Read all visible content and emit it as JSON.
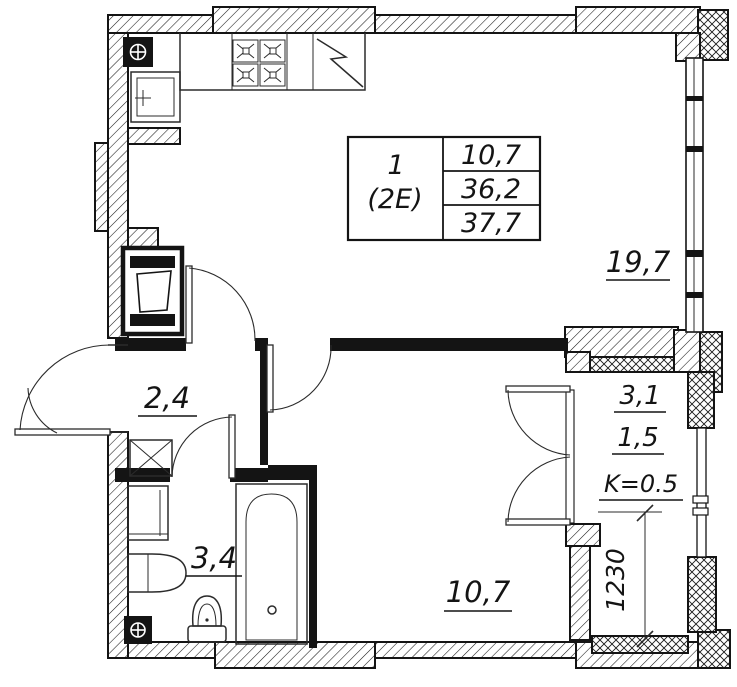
{
  "title": "Apartment floor plan",
  "info_table": {
    "apartment_number": "1",
    "apartment_type": "(2E)",
    "areas": [
      "10,7",
      "36,2",
      "37,7"
    ]
  },
  "rooms": {
    "living": {
      "area": "19,7"
    },
    "hall": {
      "area": "2,4"
    },
    "bathroom": {
      "area": "3,4"
    },
    "bedroom": {
      "area": "10,7"
    },
    "loggia": {
      "area_full": "3,1",
      "area_counted": "1,5",
      "coefficient": "K=0.5"
    }
  },
  "dimensions": {
    "loggia_depth": "1230"
  },
  "fixtures": [
    "gas-stove",
    "refrigerator",
    "kitchen-sink",
    "wash-basin",
    "bathtub",
    "toilet",
    "washing-machine",
    "ventilation-grille",
    "duct-shaft",
    "entrance-door",
    "interior-door",
    "french-balcony-door",
    "window"
  ],
  "colors": {
    "line": "#141414",
    "wall_fill": "#141414",
    "background": "#ffffff"
  }
}
